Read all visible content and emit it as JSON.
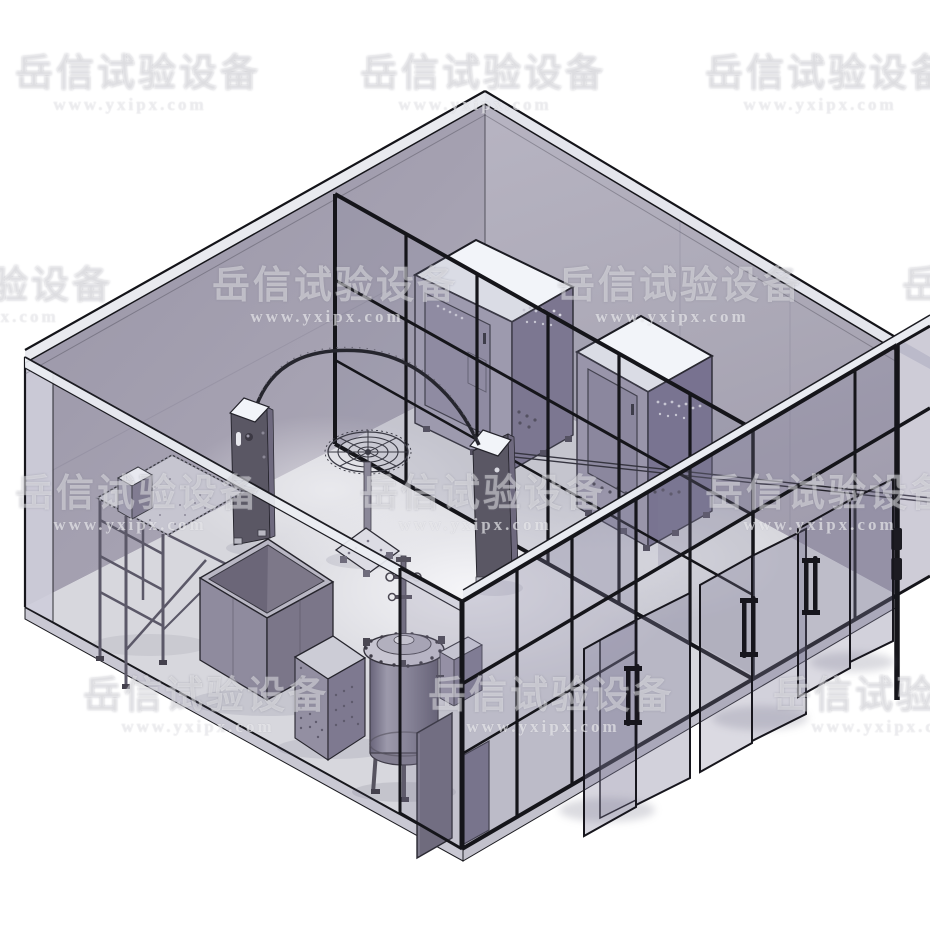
{
  "scene": {
    "type": "3d-cad-render",
    "alt": "Isometric 3D model of a walk-in test laboratory: translucent outer room, black-framed glass partition walls with open glass doors, two environmental test chambers, control pillars, oscillating-tube spray arc with rotating turntable, drip test stand, open immersion tank, small cabinet and a bolted pressure vessel",
    "equipment_names": [
      "environmental-test-chamber-1",
      "environmental-test-chamber-2",
      "control-pillar-left",
      "control-pillar-right",
      "oscillating-spray-arc",
      "spray-turntable",
      "drip-test-stand",
      "immersion-tank",
      "equipment-cabinet",
      "pressure-vessel",
      "glass-partition-wall",
      "glass-swing-doors"
    ]
  },
  "watermark": {
    "cn": "岳信试验设备",
    "url": "www.yxipx.com",
    "tile_width": 230,
    "rows": [
      {
        "top": 54,
        "offsets": [
          15,
          360,
          705
        ]
      },
      {
        "top": 266,
        "offsets": [
          -133,
          212,
          557,
          902
        ]
      },
      {
        "top": 474,
        "offsets": [
          15,
          360,
          705
        ]
      },
      {
        "top": 676,
        "offsets": [
          -262,
          83,
          428,
          773
        ]
      }
    ]
  },
  "palette": {
    "bg": "#ffffff",
    "frame": "#15151a",
    "roof_band": "#e9eaef",
    "wall_left_dark": "#9a96a7",
    "wall_left_light": "#aeabb9",
    "wall_right_light": "#b5b2c0",
    "wall_right_dark": "#a29eae",
    "floor": "#d7d7dd",
    "floor_highlight": "#f6f6f9",
    "glass": "#7f7b97",
    "chamber_front": "#a6a2b5",
    "chamber_side": "#7c7690",
    "white_top": "#f2f4f9",
    "door_panel": "#948fa6",
    "pillar": "#5a5764",
    "metal_dark": "#5b5868",
    "tank_light": "#c7c5d1",
    "panel_dark": "#6f6b7d"
  }
}
